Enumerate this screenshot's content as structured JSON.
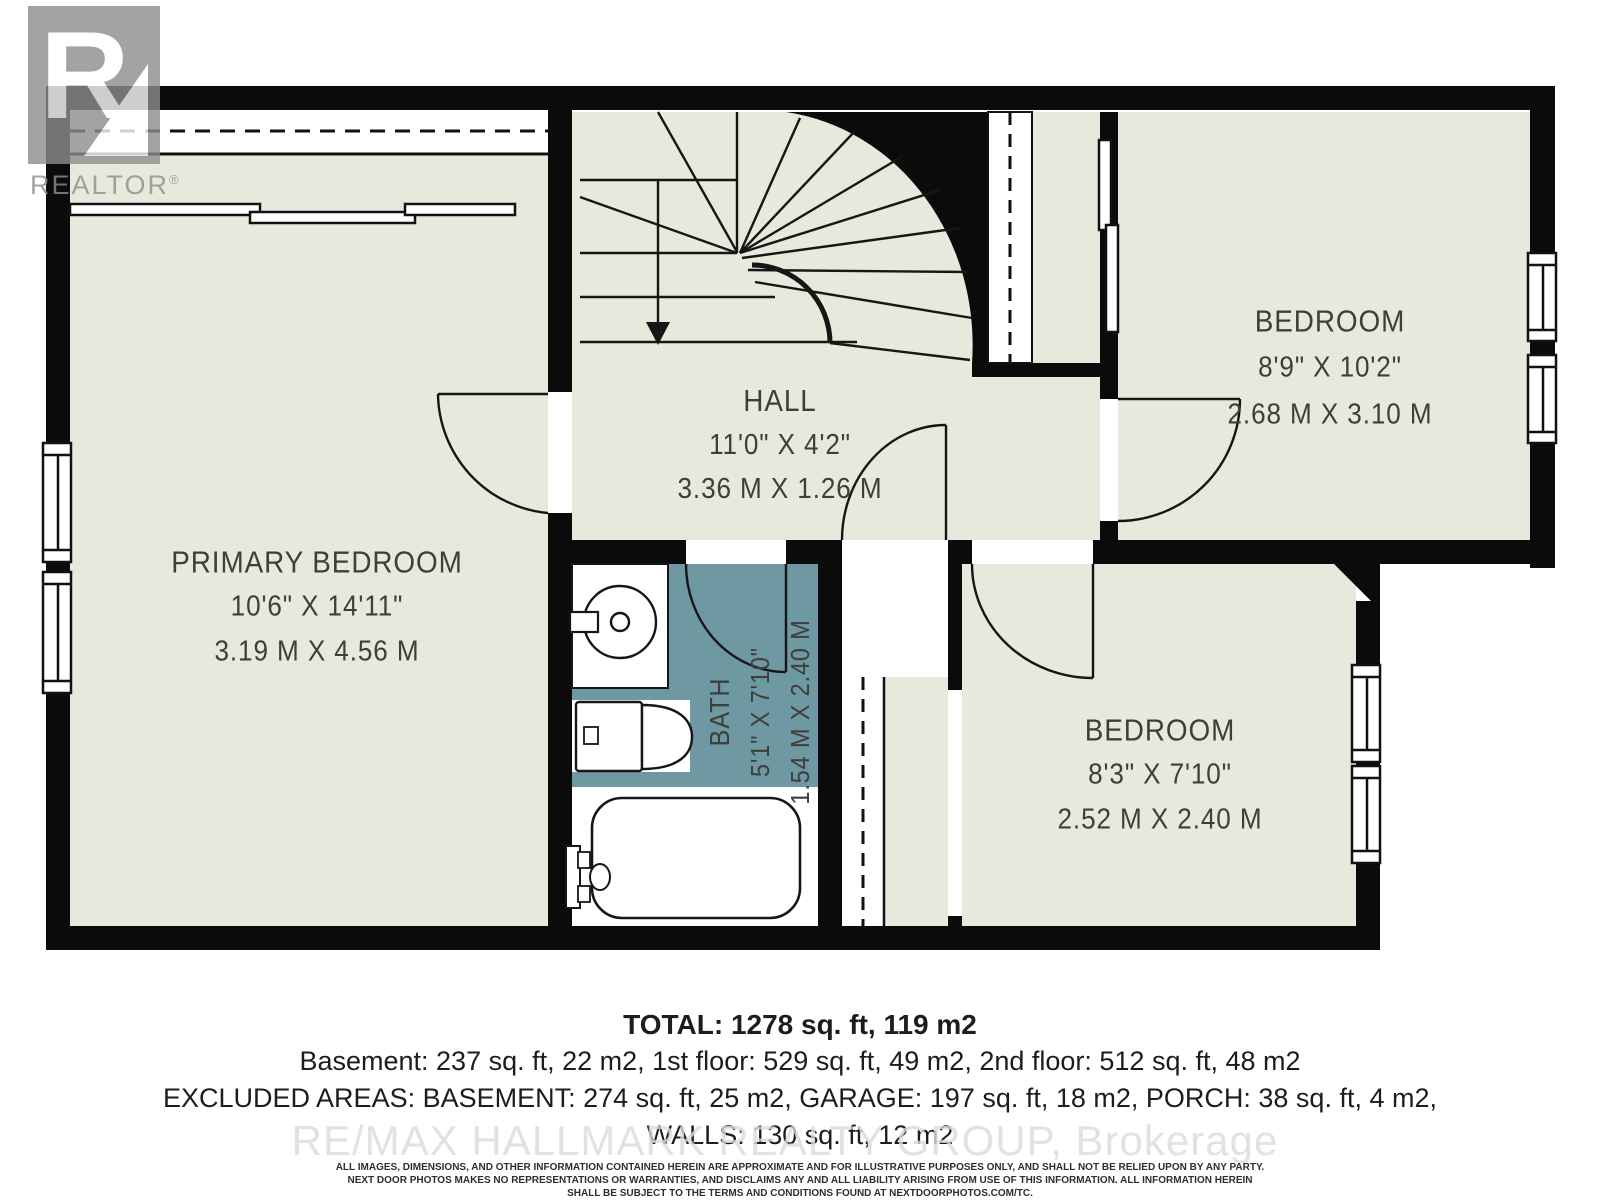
{
  "brand": {
    "name": "REALTOR",
    "registered": "®"
  },
  "watermark": "RE/MAX HALLMARK REALTY GROUP, Brokerage",
  "rooms": {
    "primary": {
      "name": "PRIMARY BEDROOM",
      "imperial": "10'6\" X 14'11\"",
      "metric": "3.19 M X 4.56 M"
    },
    "hall": {
      "name": "HALL",
      "imperial": "11'0\" X 4'2\"",
      "metric": "3.36 M X 1.26 M"
    },
    "bed_top": {
      "name": "BEDROOM",
      "imperial": "8'9\" X 10'2\"",
      "metric": "2.68 M X 3.10 M"
    },
    "bed_bottom": {
      "name": "BEDROOM",
      "imperial": "8'3\" X 7'10\"",
      "metric": "2.52 M X 2.40 M"
    },
    "bath": {
      "name": "BATH",
      "imperial": "5'1\" X 7'10\"",
      "metric": "1.54 M X 2.40 M"
    }
  },
  "summary": {
    "total": "TOTAL: 1278 sq. ft, 119 m2",
    "floors": "Basement: 237 sq. ft, 22 m2, 1st floor: 529 sq. ft, 49 m2, 2nd floor: 512 sq. ft, 48 m2",
    "excluded": "EXCLUDED AREAS: BASEMENT: 274 sq. ft, 25 m2, GARAGE: 197 sq. ft, 18 m2, PORCH: 38 sq. ft, 4 m2,",
    "walls": "WALLS: 130 sq. ft, 12 m2"
  },
  "disclaimer": {
    "line1": "ALL IMAGES, DIMENSIONS, AND OTHER INFORMATION CONTAINED HEREIN ARE APPROXIMATE AND FOR ILLUSTRATIVE PURPOSES ONLY, AND SHALL NOT BE RELIED UPON BY ANY PARTY.",
    "line2": "NEXT DOOR PHOTOS MAKES NO REPRESENTATIONS OR WARRANTIES, AND DISCLAIMS ANY AND ALL LIABILITY ARISING FROM USE OF THIS INFORMATION. ALL INFORMATION HEREIN",
    "line3": "SHALL BE SUBJECT TO THE TERMS AND CONDITIONS FOUND AT NEXTDOORPHOTOS.COM/TC."
  },
  "colors": {
    "room_fill": "#e9e8dc",
    "bath_fill": "#6e98a2",
    "wall": "#0b0b0b",
    "label_text": "#3e3e3a",
    "logo_gray": "#8d8d8d",
    "watermark_gray": "#dbdbdb"
  }
}
